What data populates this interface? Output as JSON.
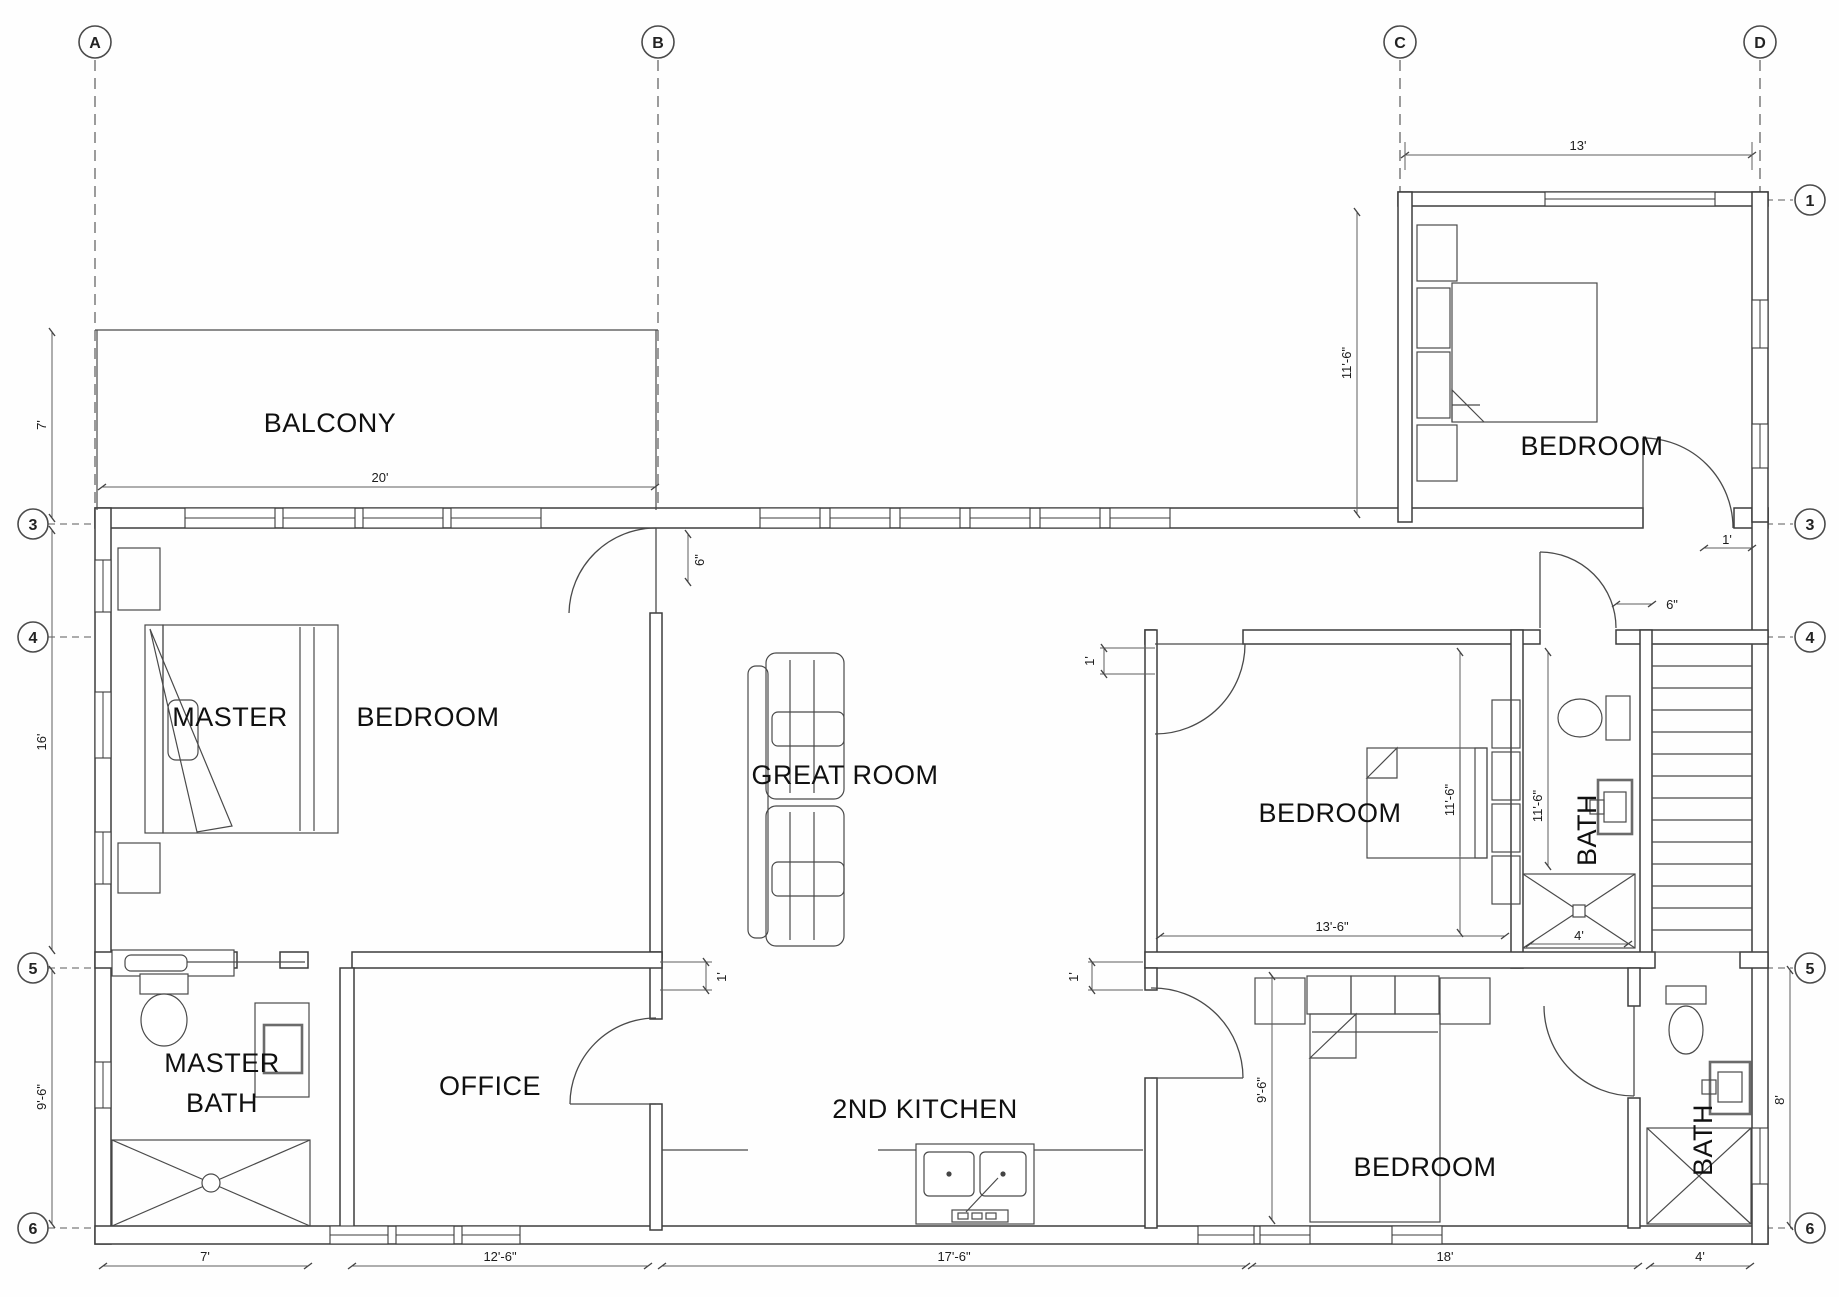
{
  "grid": {
    "col_a": "A",
    "col_b": "B",
    "col_c": "C",
    "col_d": "D",
    "row_1": "1",
    "row_3": "3",
    "row_4": "4",
    "row_5": "5",
    "row_6": "6"
  },
  "rooms": {
    "balcony": "BALCONY",
    "bedroom_top_right": "BEDROOM",
    "master_word1": "MASTER",
    "master_word2": "BEDROOM",
    "great_room": "GREAT ROOM",
    "bedroom_mid": "BEDROOM",
    "bath_mid": "BATH",
    "master_bath_line1": "MASTER",
    "master_bath_line2": "BATH",
    "office": "OFFICE",
    "second_kitchen": "2ND KITCHEN",
    "bedroom_bottom": "BEDROOM",
    "bath_bottom": "BATH"
  },
  "dims": {
    "bedroom_tr_width": "13'",
    "bedroom_tr_depth": "11'-6\"",
    "balcony_depth": "7'",
    "balcony_width": "20'",
    "master_depth": "16'",
    "master_door_offset": "6\"",
    "wall_offset_top_right": "1'",
    "hall_door_offset": "6\"",
    "bedroom_mid_offset": "1'",
    "bedroom_mid_width": "13'-6\"",
    "bedroom_mid_depth": "11'-6\"",
    "bath_mid_depth": "11'-6\"",
    "shower_mid_width": "4'",
    "kitchen_offset_left": "1'",
    "kitchen_offset_right": "1'",
    "master_bath_depth": "9'-6\"",
    "bedroom_bottom_depth": "9'-6\"",
    "bath_bottom_depth": "8'",
    "master_bath_width": "7'",
    "office_width": "12'-6\"",
    "kitchen_width": "17'-6\"",
    "bedroom_bottom_width": "18'",
    "bath_bottom_width": "4'"
  }
}
